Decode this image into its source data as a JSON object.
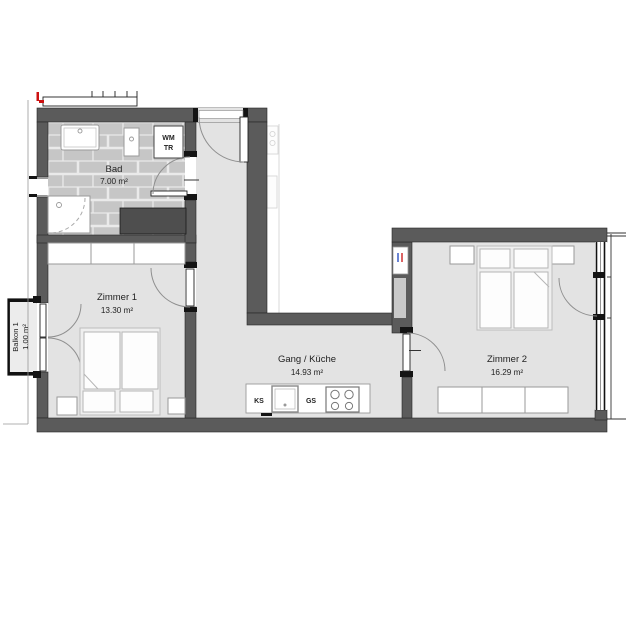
{
  "plan": {
    "title": "apartment-floorplan",
    "rooms": {
      "bad": {
        "name": "Bad",
        "area": "7.00 m²"
      },
      "zimmer1": {
        "name": "Zimmer 1",
        "area": "13.30 m²"
      },
      "gang": {
        "name": "Gang / Küche",
        "area": "14.93 m²"
      },
      "zimmer2": {
        "name": "Zimmer 2",
        "area": "16.29 m²"
      },
      "balkon1": {
        "name": "Balkon 1",
        "area": "1.00 m²"
      }
    },
    "appliances": {
      "washing_machine": "WM",
      "dryer": "TR",
      "fridge": "KS",
      "dishwasher": "GS"
    },
    "colors": {
      "wall": "#5b5b5b",
      "floor": "#e3e3e3",
      "tile": "#c6c6c6",
      "tile_grout": "#eaeaea",
      "dark_counter": "#4e4e4e",
      "swing_arc": "#8f8f8f",
      "marker_red": "#cc1111",
      "pipe_blue": "#2b4fc0",
      "pipe_red": "#cc2222"
    }
  }
}
